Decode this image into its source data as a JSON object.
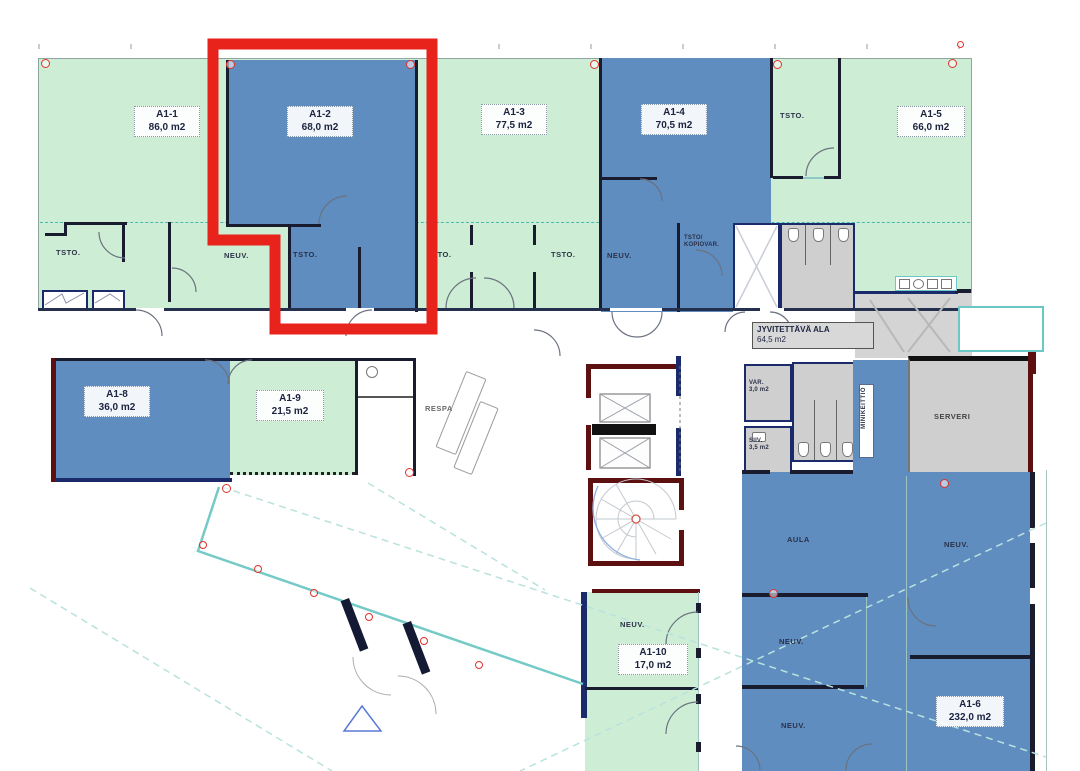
{
  "plan_title": "Kerrospohjakuva A1",
  "highlight": {
    "unit": "A1-2",
    "color": "#e8231c"
  },
  "palette": {
    "unit_green": "#cdeed5",
    "unit_blue": "#5f8dc0",
    "service_gray": "#cfcfcf",
    "highlight_red": "#e8231c",
    "glass_teal": "#74cac6",
    "wall_black": "#191c2e",
    "wall_navy": "#1a2a6a",
    "wall_maroon": "#5c1010",
    "marker_red": "#e0312b"
  },
  "rooms": {
    "a1_1": {
      "name": "A1-1",
      "area": "86,0 m2",
      "color": "green"
    },
    "a1_2": {
      "name": "A1-2",
      "area": "68,0 m2",
      "color": "blue",
      "highlighted": true
    },
    "a1_3": {
      "name": "A1-3",
      "area": "77,5 m2",
      "color": "green"
    },
    "a1_4": {
      "name": "A1-4",
      "area": "70,5 m2",
      "color": "blue"
    },
    "a1_5": {
      "name": "A1-5",
      "area": "66,0 m2",
      "color": "green"
    },
    "a1_6": {
      "name": "A1-6",
      "area": "232,0 m2",
      "color": "blue"
    },
    "a1_8": {
      "name": "A1-8",
      "area": "36,0 m2",
      "color": "blue"
    },
    "a1_9": {
      "name": "A1-9",
      "area": "21,5 m2",
      "color": "green"
    },
    "a1_10": {
      "name": "A1-10",
      "area": "17,0 m2",
      "color": "green"
    }
  },
  "areas": {
    "jyvitettava": {
      "name": "JYVITETTÄVÄ ALA",
      "area": "64,5 m2"
    },
    "var": {
      "name": "VAR.",
      "area": "3,0 m2"
    },
    "siiv": {
      "name": "SIIV.",
      "area": "3,5 m2"
    }
  },
  "labels": {
    "tsto": "TSTO.",
    "neuv": "NEUV.",
    "respa": "RESPA",
    "aula": "AULA",
    "serveri": "SERVERI",
    "minikeittio": "MINIKEITTIÖ",
    "tsto_kopiovar_line1": "TSTO/",
    "tsto_kopiovar_line2": "KOPIOVAR."
  }
}
